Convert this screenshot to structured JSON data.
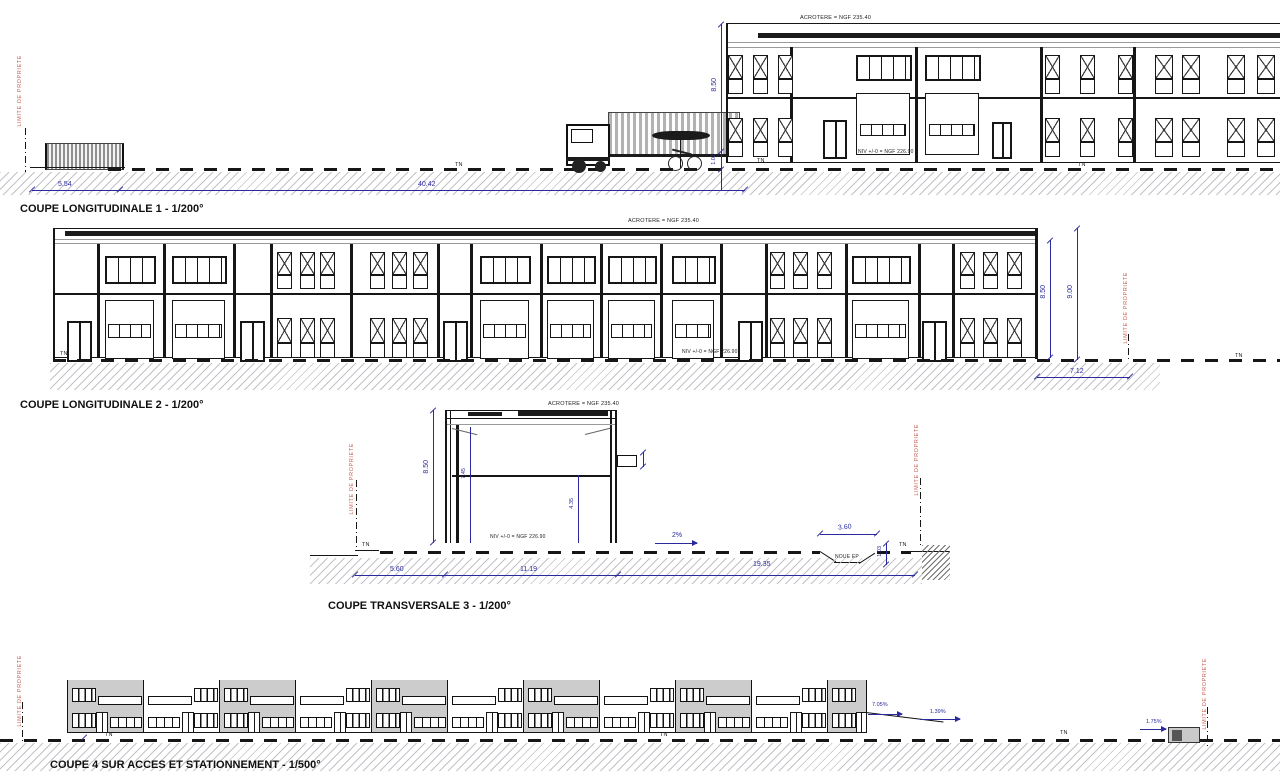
{
  "colors": {
    "dim_blue": "#2a2a9e",
    "limit_red": "#c96055",
    "line_black": "#161616",
    "unit_gray": "#cccccc"
  },
  "titles": {
    "s1": "COUPE LONGITUDINALE 1 - 1/200°",
    "s2": "COUPE LONGITUDINALE 2 - 1/200°",
    "s3": "COUPE TRANSVERSALE 3 - 1/200°",
    "s4": "COUPE 4 SUR ACCES ET STATIONNEMENT - 1/500°"
  },
  "labels": {
    "acrotere": "ACROTERE = NGF 235.40",
    "niveau": "NIV +/-0 = NGF 226.90",
    "limite": "LIMITE DE PROPRIETE",
    "tn": "TN",
    "noue": "NOUE EP"
  },
  "dims": {
    "s1": {
      "fence_width": "5.54",
      "yard_width": "40.42",
      "building_height": "8.50",
      "base_height": "1.01"
    },
    "s2": {
      "building_height": "8.50",
      "total_height": "9.00",
      "rear_width": "7.12"
    },
    "s3": {
      "building_height": "8.50",
      "clear_height": "7.45",
      "mezzanine_height": "4.35",
      "front_width": "5.60",
      "building_width": "11.19",
      "rear_width": "19.35",
      "noue_width": "3.60",
      "noue_depth": "1.03",
      "slope": "2%"
    },
    "s4": {
      "slope_a": "7.05%",
      "slope_b": "1.39%",
      "slope_c": "1.75%"
    }
  }
}
